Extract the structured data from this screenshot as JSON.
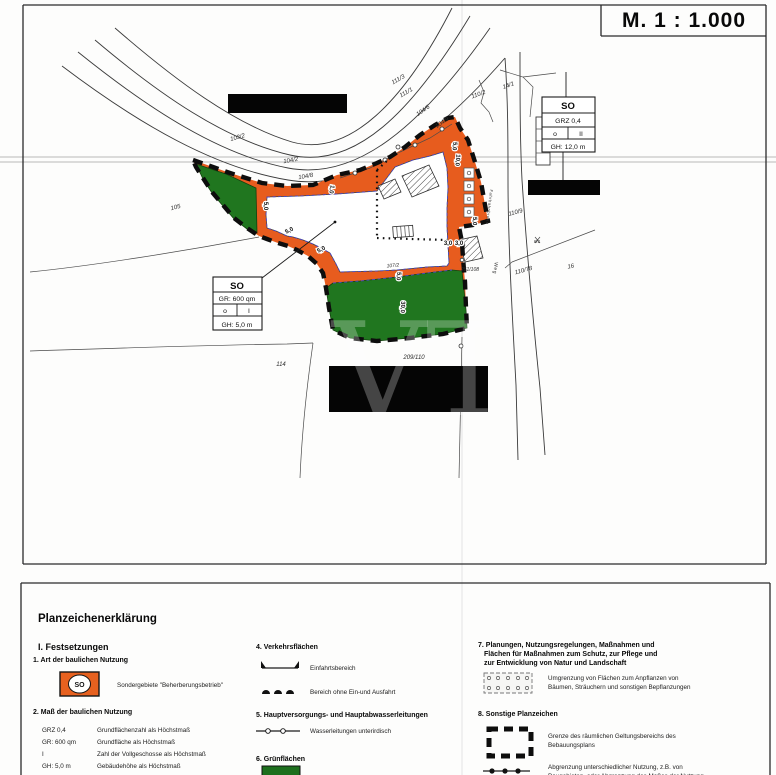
{
  "page": {
    "scale_label": "M.   1 : 1.000",
    "watermark": "VT"
  },
  "plan": {
    "so_right": {
      "title": "SO",
      "row1": "GRZ 0,4",
      "row2a": "o",
      "row2b": "II",
      "row3": "GH: 12,0 m"
    },
    "so_left": {
      "title": "SO",
      "row1": "GR: 600 qm",
      "row2a": "o",
      "row2b": "I",
      "row3": "GH: 5,0 m"
    },
    "parcel_labels": [
      {
        "t": "105",
        "x": 176,
        "y": 209,
        "r": -15
      },
      {
        "t": "103/2",
        "x": 238,
        "y": 139,
        "r": -15
      },
      {
        "t": "104/2",
        "x": 291,
        "y": 162,
        "r": -10
      },
      {
        "t": "104/8",
        "x": 306,
        "y": 178,
        "r": -10
      },
      {
        "t": "104/6",
        "x": 424,
        "y": 112,
        "r": -35
      },
      {
        "t": "104/9",
        "x": 443,
        "y": 124,
        "r": -35
      },
      {
        "t": "111/3",
        "x": 399,
        "y": 81,
        "r": -30
      },
      {
        "t": "111/1",
        "x": 407,
        "y": 94,
        "r": -30
      },
      {
        "t": "110/2",
        "x": 479,
        "y": 96,
        "r": -20
      },
      {
        "t": "14/1",
        "x": 509,
        "y": 87,
        "r": -20
      },
      {
        "t": "110/9",
        "x": 516,
        "y": 214,
        "r": -15
      },
      {
        "t": "110/78",
        "x": 524,
        "y": 272,
        "r": -15
      },
      {
        "t": "251/108",
        "x": 470,
        "y": 271,
        "r": 0,
        "s": 5
      },
      {
        "t": "16",
        "x": 571,
        "y": 268,
        "r": -10
      },
      {
        "t": "8/1",
        "x": 537,
        "y": 243,
        "r": 0,
        "s": 4.5
      },
      {
        "t": "114",
        "x": 281,
        "y": 366,
        "r": 0
      },
      {
        "t": "209/110",
        "x": 414,
        "y": 359,
        "r": 0
      },
      {
        "t": "107/2",
        "x": 393,
        "y": 267,
        "r": -5,
        "s": 5
      }
    ],
    "dim_labels": [
      {
        "t": "5,0",
        "x": 264,
        "y": 206,
        "r": 90
      },
      {
        "t": "1,0",
        "x": 330,
        "y": 189,
        "r": 100
      },
      {
        "t": "5,0",
        "x": 290,
        "y": 232,
        "r": -27
      },
      {
        "t": "5,0",
        "x": 322,
        "y": 251,
        "r": -27
      },
      {
        "t": "5,0",
        "x": 397,
        "y": 276,
        "r": 95
      },
      {
        "t": "30,0",
        "x": 401,
        "y": 307,
        "r": 93
      },
      {
        "t": "5,0",
        "x": 453,
        "y": 146,
        "r": 95
      },
      {
        "t": "10,0",
        "x": 456,
        "y": 160,
        "r": 95
      },
      {
        "t": "5,0",
        "x": 473,
        "y": 221,
        "r": 92
      },
      {
        "t": "3,0",
        "x": 448,
        "y": 245,
        "r": 0
      },
      {
        "t": "3,0",
        "x": 459,
        "y": 245,
        "r": 0
      }
    ],
    "street_labels": [
      {
        "t": "Weg",
        "x": 494,
        "y": 268,
        "r": 97
      },
      {
        "t": "Fahrbahnbreite",
        "x": 488,
        "y": 207,
        "r": 97,
        "s": 4
      }
    ]
  },
  "legend": {
    "box_title": "Planzeichenerklärung",
    "festsetzungen": "I. Festsetzungen",
    "s1": {
      "h": "1. Art der baulichen Nutzung",
      "so": "SO",
      "label": "Sondergebiete \"Beherberungsbetrieb\""
    },
    "s2": {
      "h": "2. Maß der baulichen Nutzung",
      "rows": [
        [
          "GRZ 0,4",
          "Grundflächenzahl als Höchstmaß"
        ],
        [
          "GR: 600 qm",
          "Grundfläche als Höchstmaß"
        ],
        [
          "I",
          "Zahl der Vollgeschosse als Höchstmaß"
        ],
        [
          "GH: 5,0 m",
          "Gebäudehöhe als Höchstmaß"
        ]
      ]
    },
    "s3": {
      "h": "3. Bauweise, Baulinien, Baugrenzen"
    },
    "s4": {
      "h": "4. Verkehrsflächen",
      "l1": "Einfahrtsbereich",
      "l2": "Bereich ohne Ein-und Ausfahrt"
    },
    "s5": {
      "h": "5. Hauptversorgungs- und Hauptabwasserleitungen",
      "l1": "Wasserleitungen unterirdisch"
    },
    "s6": {
      "h": "6. Grünflächen"
    },
    "s7": {
      "h1": "7. Planungen, Nutzungsregelungen, Maßnahmen und",
      "h2": "Flächen für Maßnahmen zum Schutz, zur Pflege und",
      "h3": "zur Entwicklung von Natur und Landschaft",
      "l1": "Umgrenzung von Flächen zum Anpflanzen von",
      "l2": "Bäumen, Sträuchern und sonstigen Bepflanzungen"
    },
    "s8": {
      "h": "8. Sonstige Planzeichen",
      "a1": "Grenze des räumlichen Geltungsbereichs des",
      "a2": "Bebauungsplans",
      "b1": "Abgrenzung unterschiedlicher Nutzung, z.B. von",
      "b2": "Baugebieten, oder Abgrenzung des Maßes der Nutzung"
    }
  }
}
